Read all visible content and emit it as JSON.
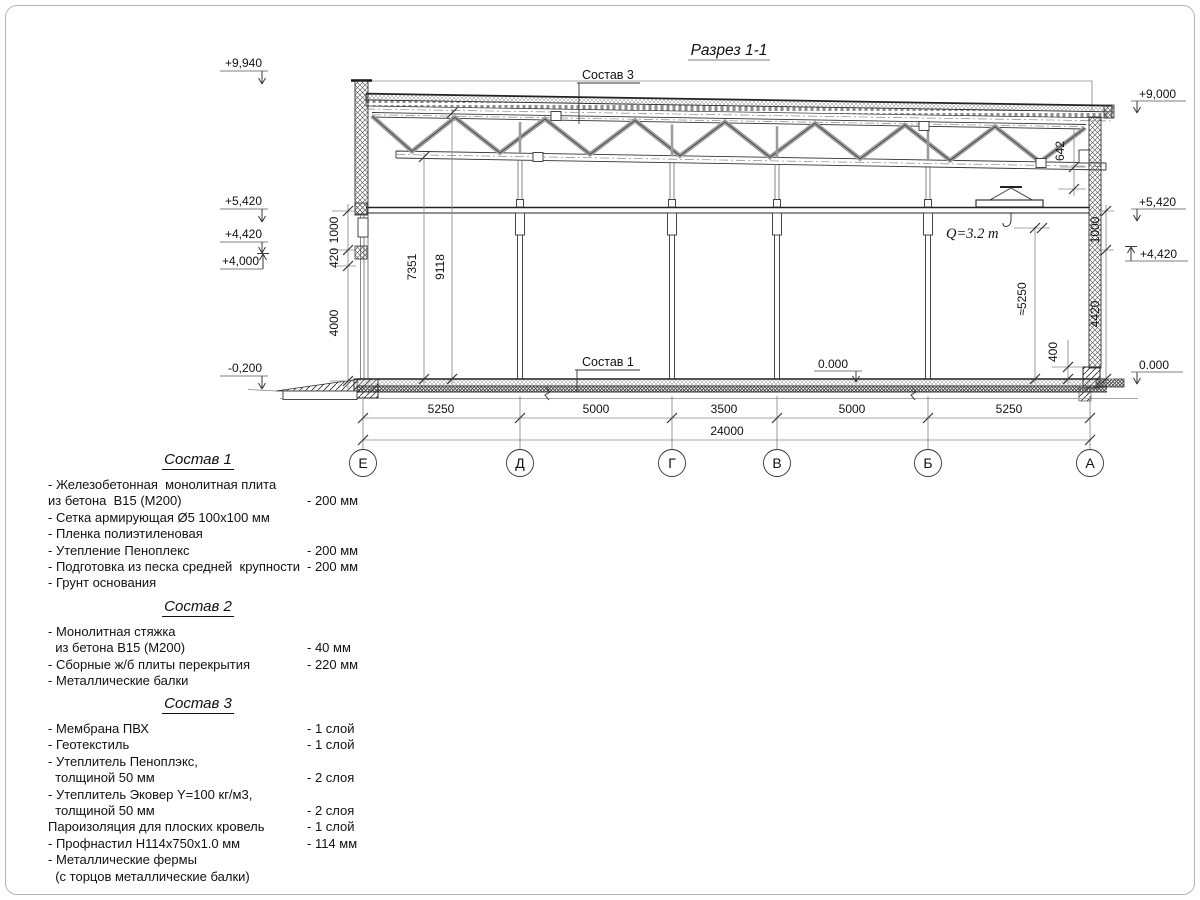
{
  "page": {
    "title": "Разрез 1-1"
  },
  "drawing": {
    "section_label_top": "Состав 3",
    "section_label_floor": "Состав 1",
    "crane_capacity": "Q=3.2 т",
    "elevations": {
      "left_parapet": "+9,940",
      "left_beam": "+5,420",
      "left_col": "+4,420",
      "left_400": "+4,000",
      "left_ground": "-0,200",
      "right_roof": "+9,000",
      "right_beam": "+5,420",
      "right_col": "+4,420",
      "right_floor": "0.000",
      "floor_interior": "0.000"
    },
    "dims": {
      "v_left": [
        "1000",
        "420",
        "4000"
      ],
      "v_interior": [
        "7351",
        "9118"
      ],
      "truss_depth": "642",
      "hook_height": "≈5250",
      "plinth": "400",
      "v_right": [
        "1000",
        "4420"
      ],
      "spans": [
        "5250",
        "5000",
        "3500",
        "5000",
        "5250"
      ],
      "total": "24000"
    },
    "axes": [
      "Е",
      "Д",
      "Г",
      "В",
      "Б",
      "А"
    ]
  },
  "compositions": [
    {
      "title": "Состав 1",
      "rows": [
        {
          "text": "- Железобетонная  монолитная плита",
          "value": ""
        },
        {
          "text": "из бетона  В15 (М200)",
          "value": "- 200 мм"
        },
        {
          "text": "- Сетка армирующая Ø5 100х100 мм",
          "value": ""
        },
        {
          "text": "- Пленка полиэтиленовая",
          "value": ""
        },
        {
          "text": "- Утепление Пеноплекс",
          "value": "- 200 мм"
        },
        {
          "text": "- Подготовка из песка средней  крупности",
          "value": "- 200 мм"
        },
        {
          "text": "- Грунт основания",
          "value": ""
        }
      ]
    },
    {
      "title": "Состав 2",
      "rows": [
        {
          "text": "- Монолитная стяжка",
          "value": ""
        },
        {
          "text": "  из бетона В15 (М200)",
          "value": "- 40 мм"
        },
        {
          "text": "- Сборные ж/б плиты перекрытия",
          "value": "- 220 мм"
        },
        {
          "text": "- Металлические балки",
          "value": ""
        }
      ]
    },
    {
      "title": "Состав 3",
      "rows": [
        {
          "text": "- Мембрана ПВХ",
          "value": "- 1 слой"
        },
        {
          "text": "- Геотекстиль",
          "value": "- 1 слой"
        },
        {
          "text": "- Утеплитель Пеноплэкс,",
          "value": ""
        },
        {
          "text": "  толщиной 50 мм",
          "value": "- 2 слоя"
        },
        {
          "text": "- Утеплитель Эковер Y=100 кг/м3,",
          "value": ""
        },
        {
          "text": "  толщиной 50 мм",
          "value": "- 2 слоя"
        },
        {
          "text": "Пароизоляция для плоских кровель",
          "value": "- 1 слой"
        },
        {
          "text": "- Профнастил Н114х750х1.0 мм",
          "value": "- 114 мм"
        },
        {
          "text": "- Металлические фермы",
          "value": ""
        },
        {
          "text": "  (с торцов металлические балки)",
          "value": ""
        }
      ]
    }
  ]
}
